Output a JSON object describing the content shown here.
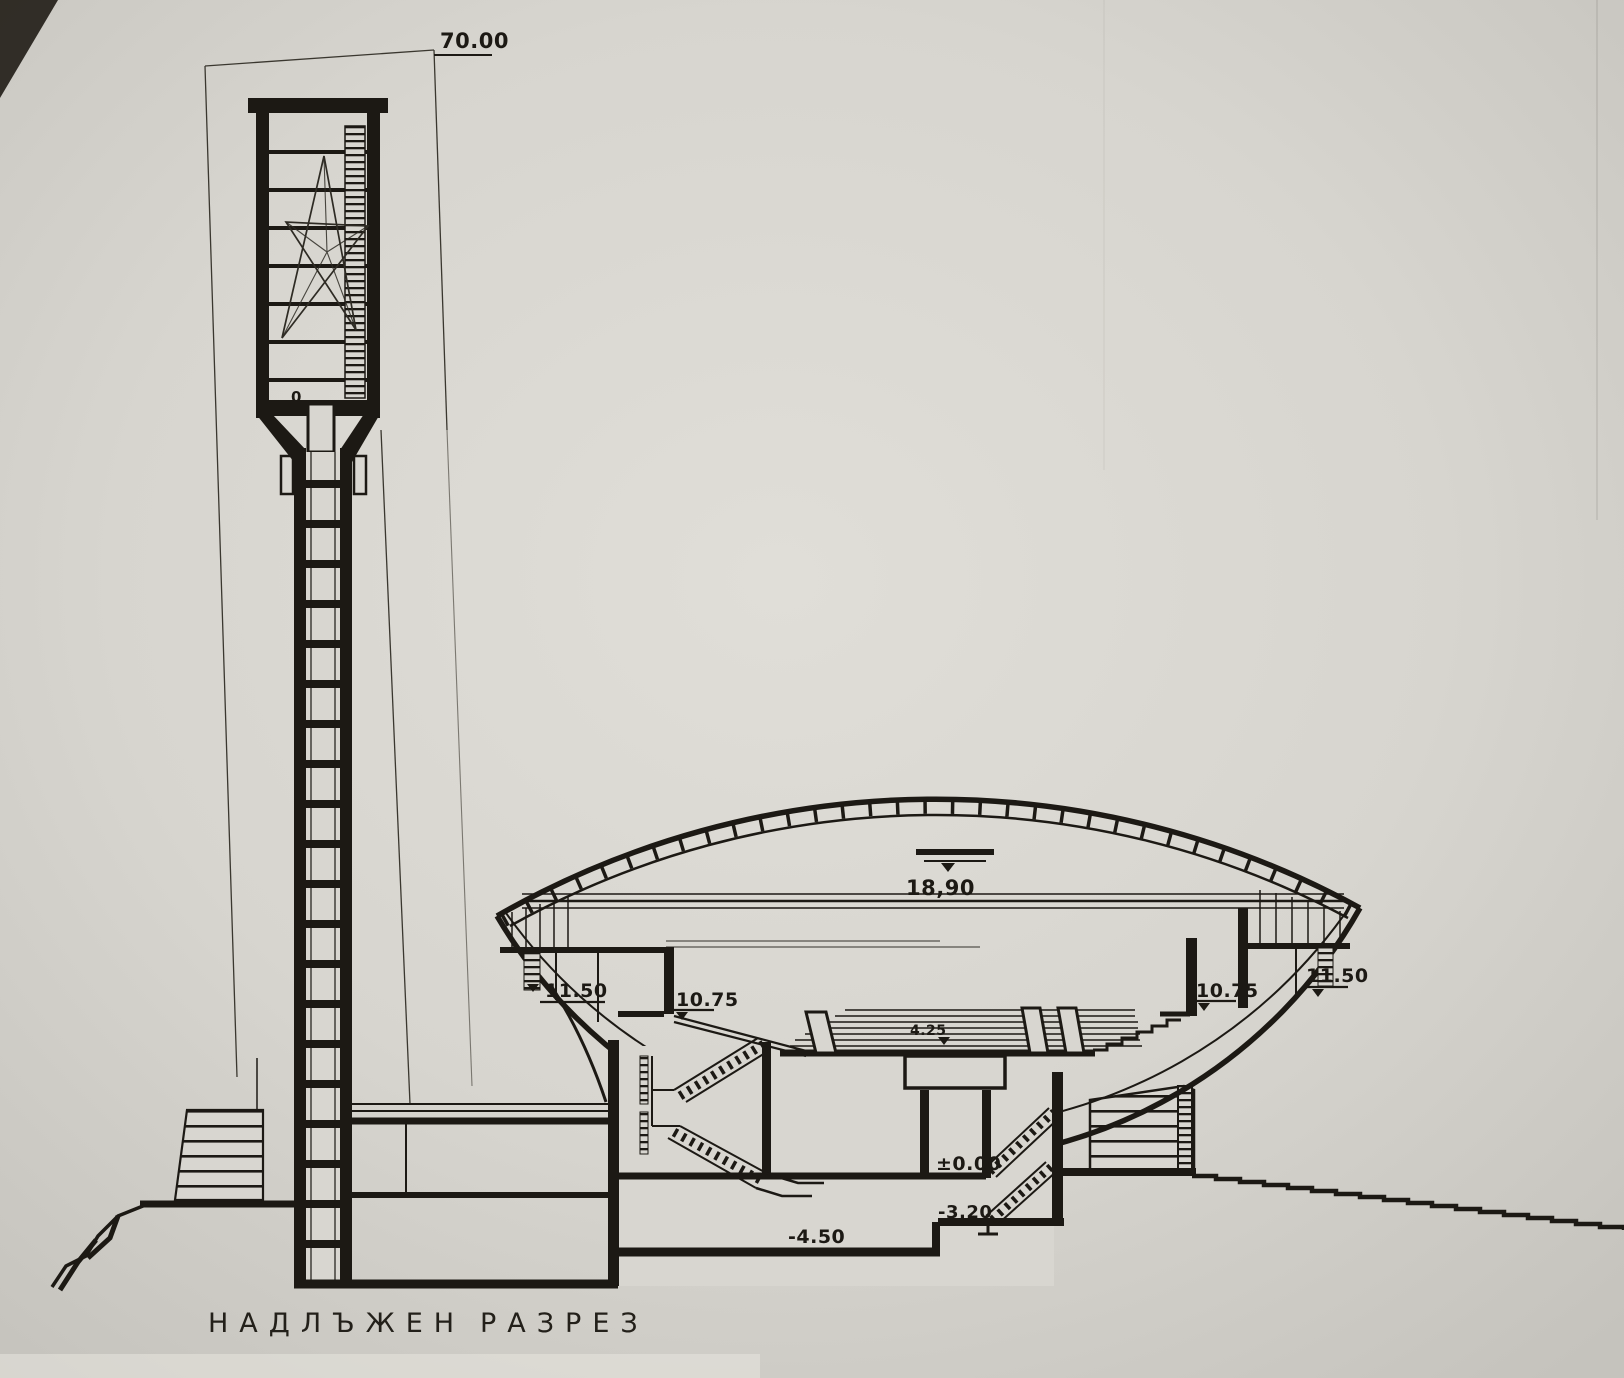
{
  "drawing": {
    "title": {
      "word1": "НАДЛЪЖЕН",
      "word2": "РАЗРЕЗ"
    },
    "levels": {
      "tower_height": "70.00",
      "dome_top": "18,90",
      "gallery_left_upper": "11.50",
      "gallery_left_lower": "10.75",
      "hall_floor": "4.25",
      "gallery_right_lower": "10.75",
      "gallery_right_upper": "11.50",
      "ground": "±0.00",
      "basement_upper": "-3.20",
      "basement_lower": "-4.50",
      "tower_door": "0"
    },
    "colors": {
      "paper": "#d8d6d0",
      "ink": "#1c1914"
    }
  }
}
